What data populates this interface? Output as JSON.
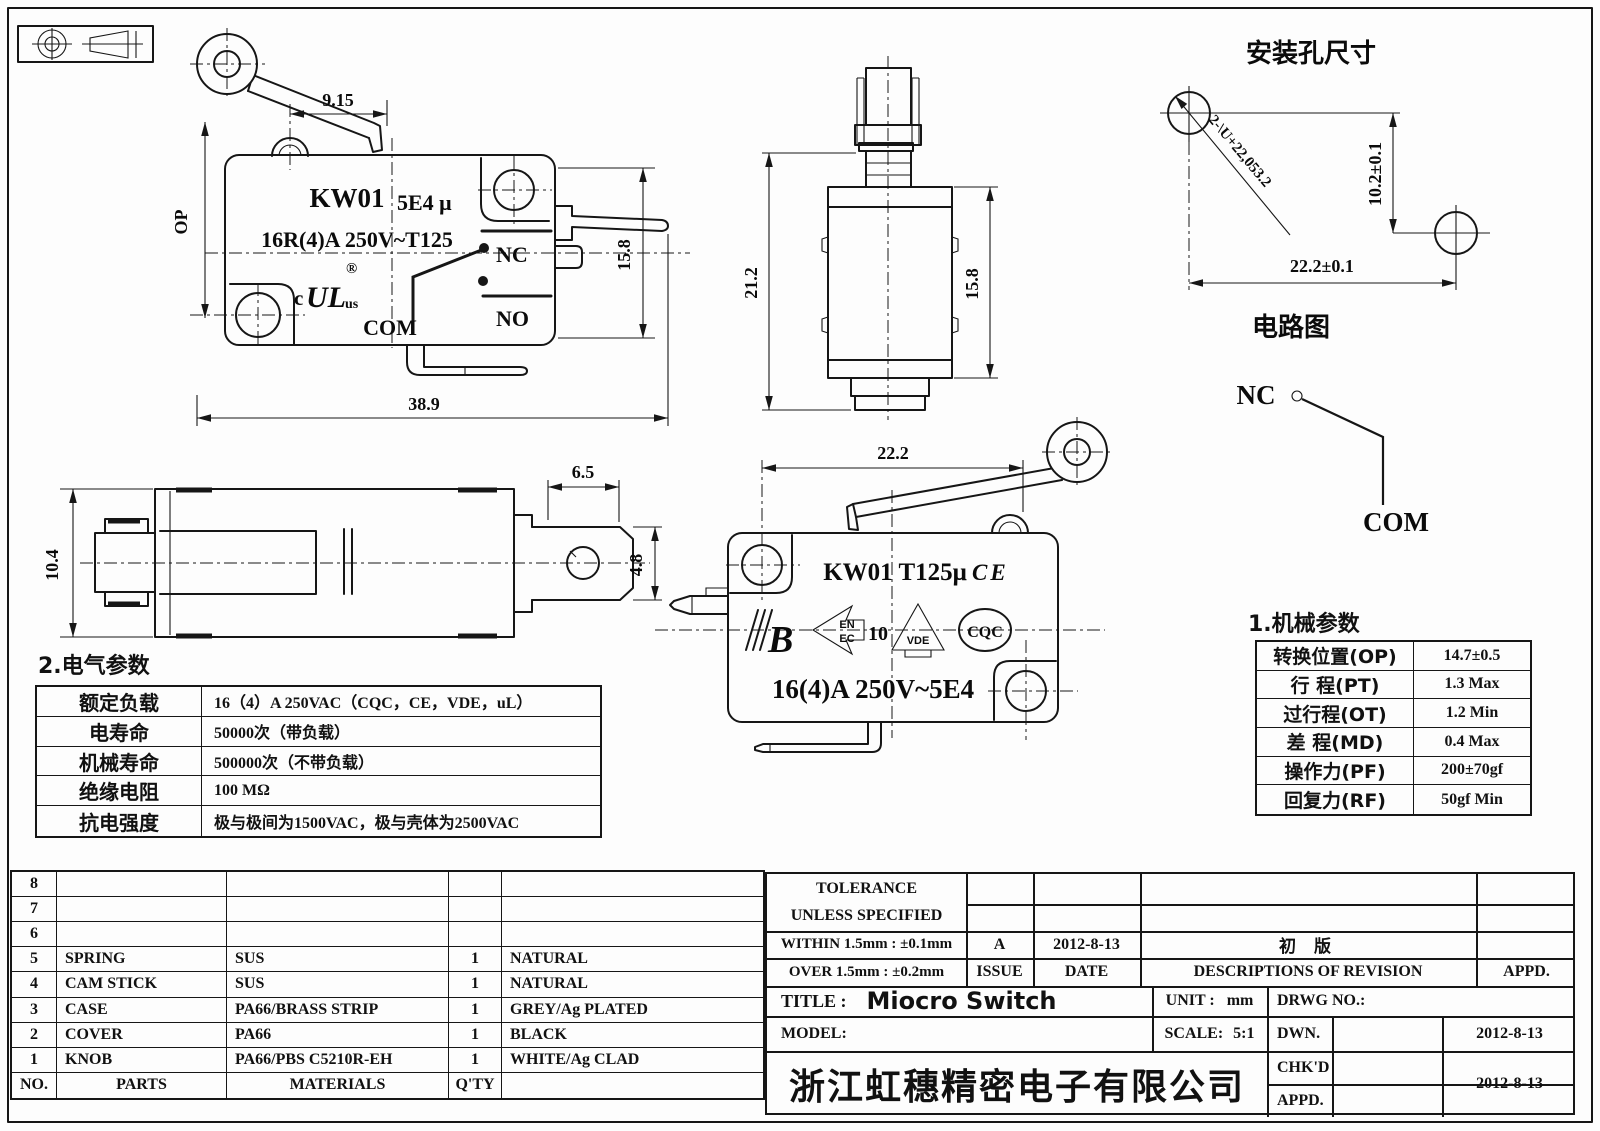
{
  "views": {
    "side": {
      "model": "KW01",
      "code": "5E4 μ",
      "rating": "16R(4)A 250V~T125",
      "nc": "NC",
      "no": "NO",
      "com": "COM",
      "ul_c": "c",
      "ul_mark": "UL",
      "ul_us": "us",
      "reg": "®",
      "dim_top": "9.15",
      "dim_op": "OP",
      "dim_right": "15.8",
      "dim_bottom": "38.9"
    },
    "front": {
      "dim_left": "21.2",
      "dim_right": "15.8"
    },
    "top": {
      "dim_left": "10.4",
      "dim_top": "6.5",
      "dim_right": "4.8"
    },
    "bottom": {
      "dim_top": "22.2",
      "model": "KW01 T125μ",
      "ce": "CE",
      "logo_b": "B",
      "logo_en": "EN",
      "logo_ec": "EC",
      "logo_10": "10",
      "logo_vde": "VDE",
      "logo_cqc": "CQC",
      "rating": "16(4)A 250V~5E4"
    }
  },
  "mounting": {
    "title": "安装孔尺寸",
    "leader": "2-\\U+22,053.2",
    "dim_v": "10.2±0.1",
    "dim_h": "22.2±0.1"
  },
  "circuit": {
    "title": "电路图",
    "nc": "NC",
    "com": "COM"
  },
  "mech": {
    "title": "1.机械参数",
    "rows": [
      [
        "转换位置(OP)",
        "14.7±0.5"
      ],
      [
        "行 程(PT)",
        "1.3 Max"
      ],
      [
        "过行程(OT)",
        "1.2 Min"
      ],
      [
        "差 程(MD)",
        "0.4 Max"
      ],
      [
        "操作力(PF)",
        "200±70gf"
      ],
      [
        "回复力(RF)",
        "50gf Min"
      ]
    ]
  },
  "elec": {
    "title": "2.电气参数",
    "rows": [
      [
        "额定负载",
        "16（4）A 250VAC（CQC，CE，VDE，uL）"
      ],
      [
        "电寿命",
        "50000次（带负载）"
      ],
      [
        "机械寿命",
        "500000次（不带负载）"
      ],
      [
        "绝缘电阻",
        "100 MΩ"
      ],
      [
        "抗电强度",
        "极与极间为1500VAC，极与壳体为2500VAC"
      ]
    ]
  },
  "parts": {
    "rows": [
      [
        "8",
        "",
        "",
        "",
        ""
      ],
      [
        "7",
        "",
        "",
        "",
        ""
      ],
      [
        "6",
        "",
        "",
        "",
        ""
      ],
      [
        "5",
        "SPRING",
        "SUS",
        "1",
        "NATURAL"
      ],
      [
        "4",
        "CAM STICK",
        "SUS",
        "1",
        "NATURAL"
      ],
      [
        "3",
        "CASE",
        "PA66/BRASS STRIP",
        "1",
        "GREY/Ag PLATED"
      ],
      [
        "2",
        "COVER",
        "PA66",
        "1",
        "BLACK"
      ],
      [
        "1",
        "KNOB",
        "PA66/PBS C5210R-EH",
        "1",
        "WHITE/Ag CLAD"
      ]
    ],
    "footer": [
      "NO.",
      "PARTS",
      "MATERIALS",
      "Q'TY",
      ""
    ]
  },
  "tb": {
    "tol1": "TOLERANCE",
    "tol2": "UNLESS  SPECIFIED",
    "within": "WITHIN 1.5mm : ±0.1mm",
    "over": "OVER 1.5mm : ±0.2mm",
    "issue_val": "A",
    "issue": "ISSUE",
    "date_val": "2012-8-13",
    "date": "DATE",
    "rev_val": "初 版",
    "rev": "DESCRIPTIONS OF REVISION",
    "appd": "APPD.",
    "title_label": "TITLE :",
    "title_val": "Miocro Switch",
    "unit_label": "UNIT :",
    "unit_val": "mm",
    "drwg": "DRWG NO.:",
    "model": "MODEL:",
    "scale_label": "SCALE:",
    "scale_val": "5:1",
    "dwn": "DWN.",
    "dwn_date": "2012-8-13",
    "chkd": "CHK'D",
    "chkd_date": "2012-8-13",
    "appd2": "APPD.",
    "company": "浙江虹穗精密电子有限公司"
  }
}
